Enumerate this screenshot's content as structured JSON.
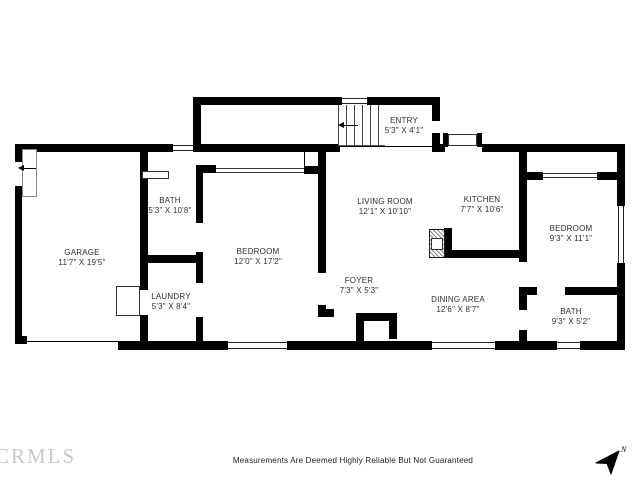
{
  "rooms": {
    "garage": {
      "name": "GARAGE",
      "dims": "11'7\" X 19'5\""
    },
    "bath1": {
      "name": "BATH",
      "dims": "5'3\" X 10'8\""
    },
    "bedroom1": {
      "name": "BEDROOM",
      "dims": "12'0\" X 17'2\""
    },
    "laundry": {
      "name": "LAUNDRY",
      "dims": "5'3\" X 8'4\""
    },
    "living_room": {
      "name": "LIVING ROOM",
      "dims": "12'1\" X 10'10\""
    },
    "entry": {
      "name": "ENTRY",
      "dims": "5'3\" X 4'1\""
    },
    "kitchen": {
      "name": "KITCHEN",
      "dims": "7'7\" X 10'6\""
    },
    "foyer": {
      "name": "FOYER",
      "dims": "7'3\" X 5'3\""
    },
    "dining_area": {
      "name": "DINING AREA",
      "dims": "12'6\" X 8'7\""
    },
    "bedroom2": {
      "name": "BEDROOM",
      "dims": "9'3\" X 11'1\""
    },
    "bath2": {
      "name": "BATH",
      "dims": "9'3\" X 5'2\""
    }
  },
  "footer": {
    "watermark": "CRMLS",
    "disclaimer": "Measurements Are Deemed Highly Reliable But Not Guaranteed",
    "compass_label": "N"
  },
  "colors": {
    "wall": "#000000",
    "text": "#2e2e2e",
    "watermark": "#c9c9c9"
  }
}
